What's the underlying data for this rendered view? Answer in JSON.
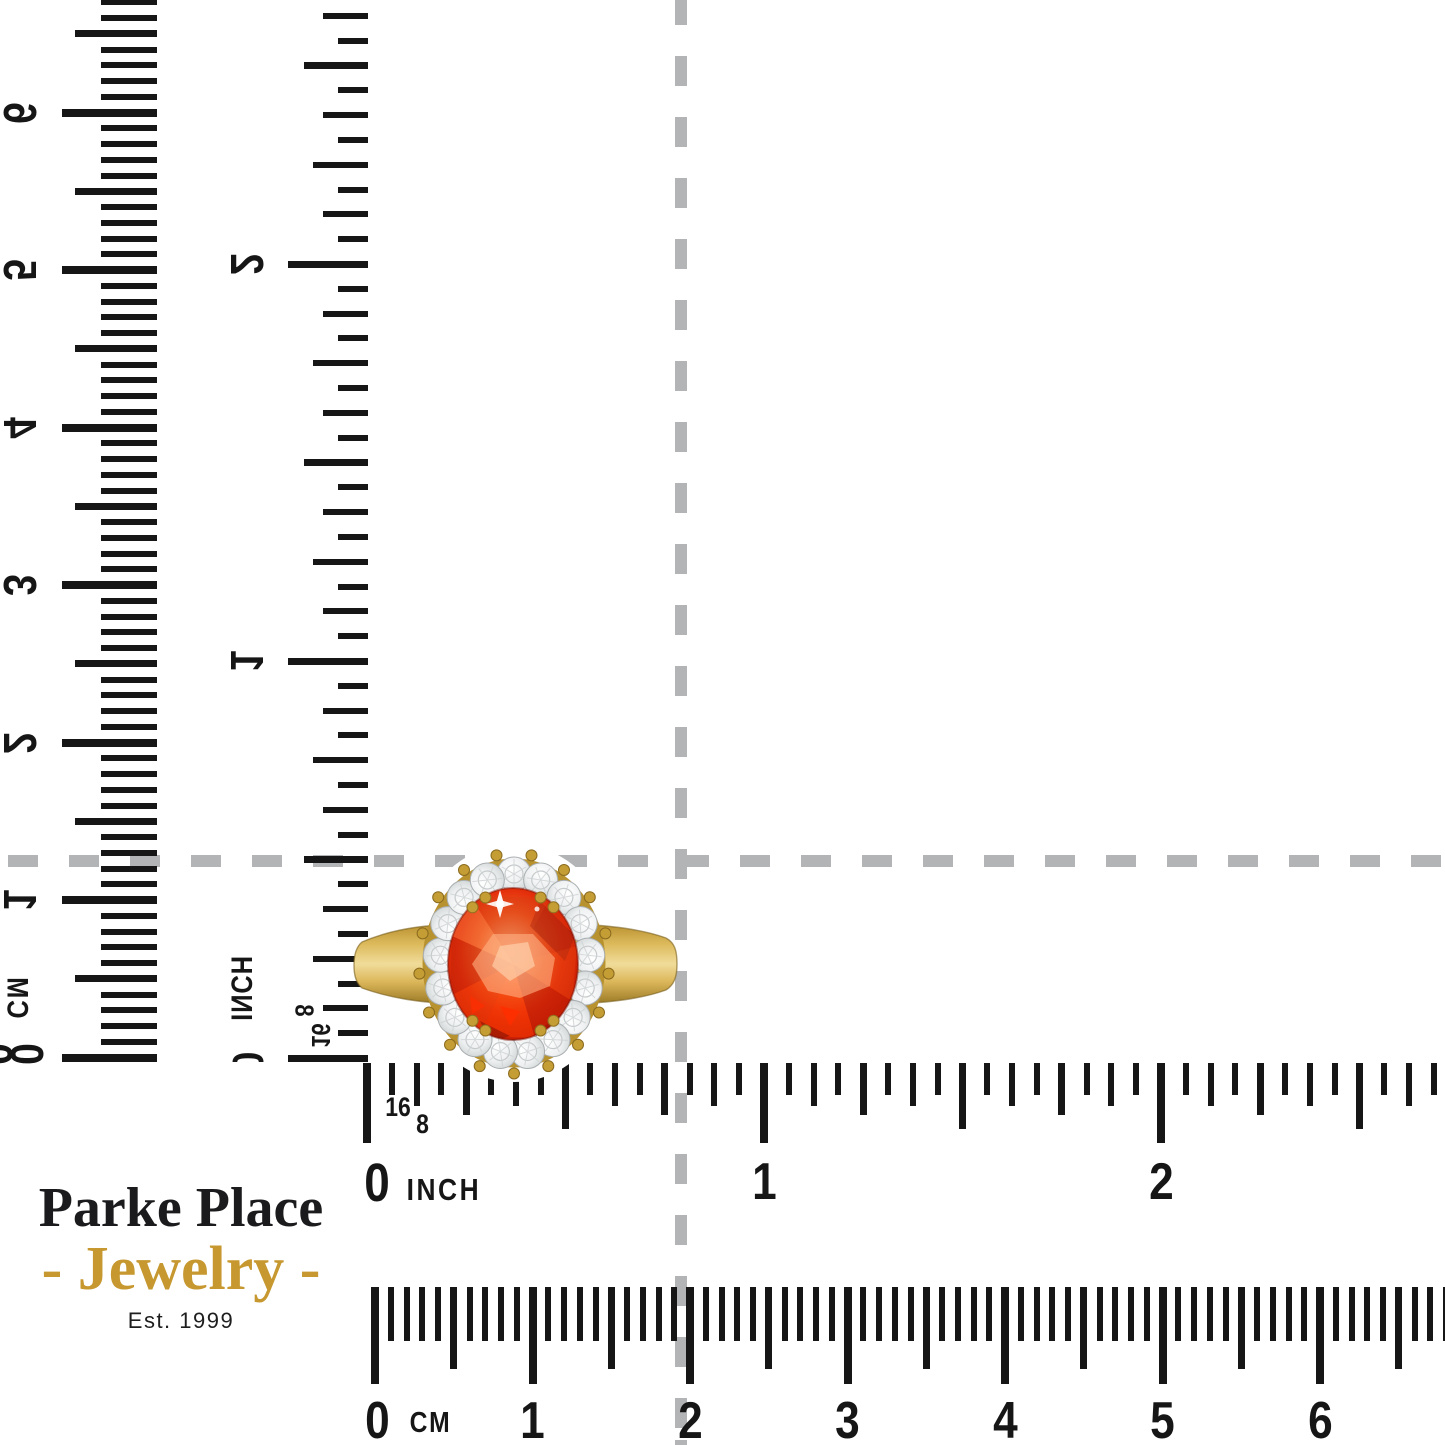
{
  "page": {
    "background": "#ffffff",
    "ink_color": "#161616",
    "crosshair_color": "#b2b4b6"
  },
  "crosshair": {
    "horizontal_line_style": "dashed",
    "vertical_line_style": "dashed"
  },
  "rulers": {
    "cm_vertical": {
      "unit": "CM",
      "zero": "0",
      "zero_clipped": "0",
      "numbers": [
        "1",
        "2",
        "3",
        "4",
        "5",
        "6"
      ]
    },
    "inch_vertical": {
      "unit": "INCH",
      "zero": "0",
      "sixteenth_label": "16",
      "eighth_label": "8",
      "numbers": [
        "1",
        "2"
      ]
    },
    "inch_horizontal": {
      "unit": "INCH",
      "zero": "0",
      "sixteenth_label": "16",
      "eighth_label": "8",
      "numbers": [
        "1",
        "2"
      ]
    },
    "cm_horizontal": {
      "unit": "CM",
      "zero": "0",
      "numbers": [
        "1",
        "2",
        "3",
        "4",
        "5",
        "6"
      ]
    }
  },
  "logo": {
    "name": "Parke Place",
    "tagline": "- Jewelry -",
    "established": "Est. 1999",
    "name_color": "#1b1b1d",
    "accent_color": "#c6982f"
  },
  "ring": {
    "description": "Oval red-orange gemstone ring with round diamond halo on yellow gold band",
    "halo_diamond_count": 17,
    "band_color": "#d4ae4c",
    "stone_color": "#e23009",
    "diamond_color": "#edeff0",
    "prong_color": "#c49d35"
  }
}
